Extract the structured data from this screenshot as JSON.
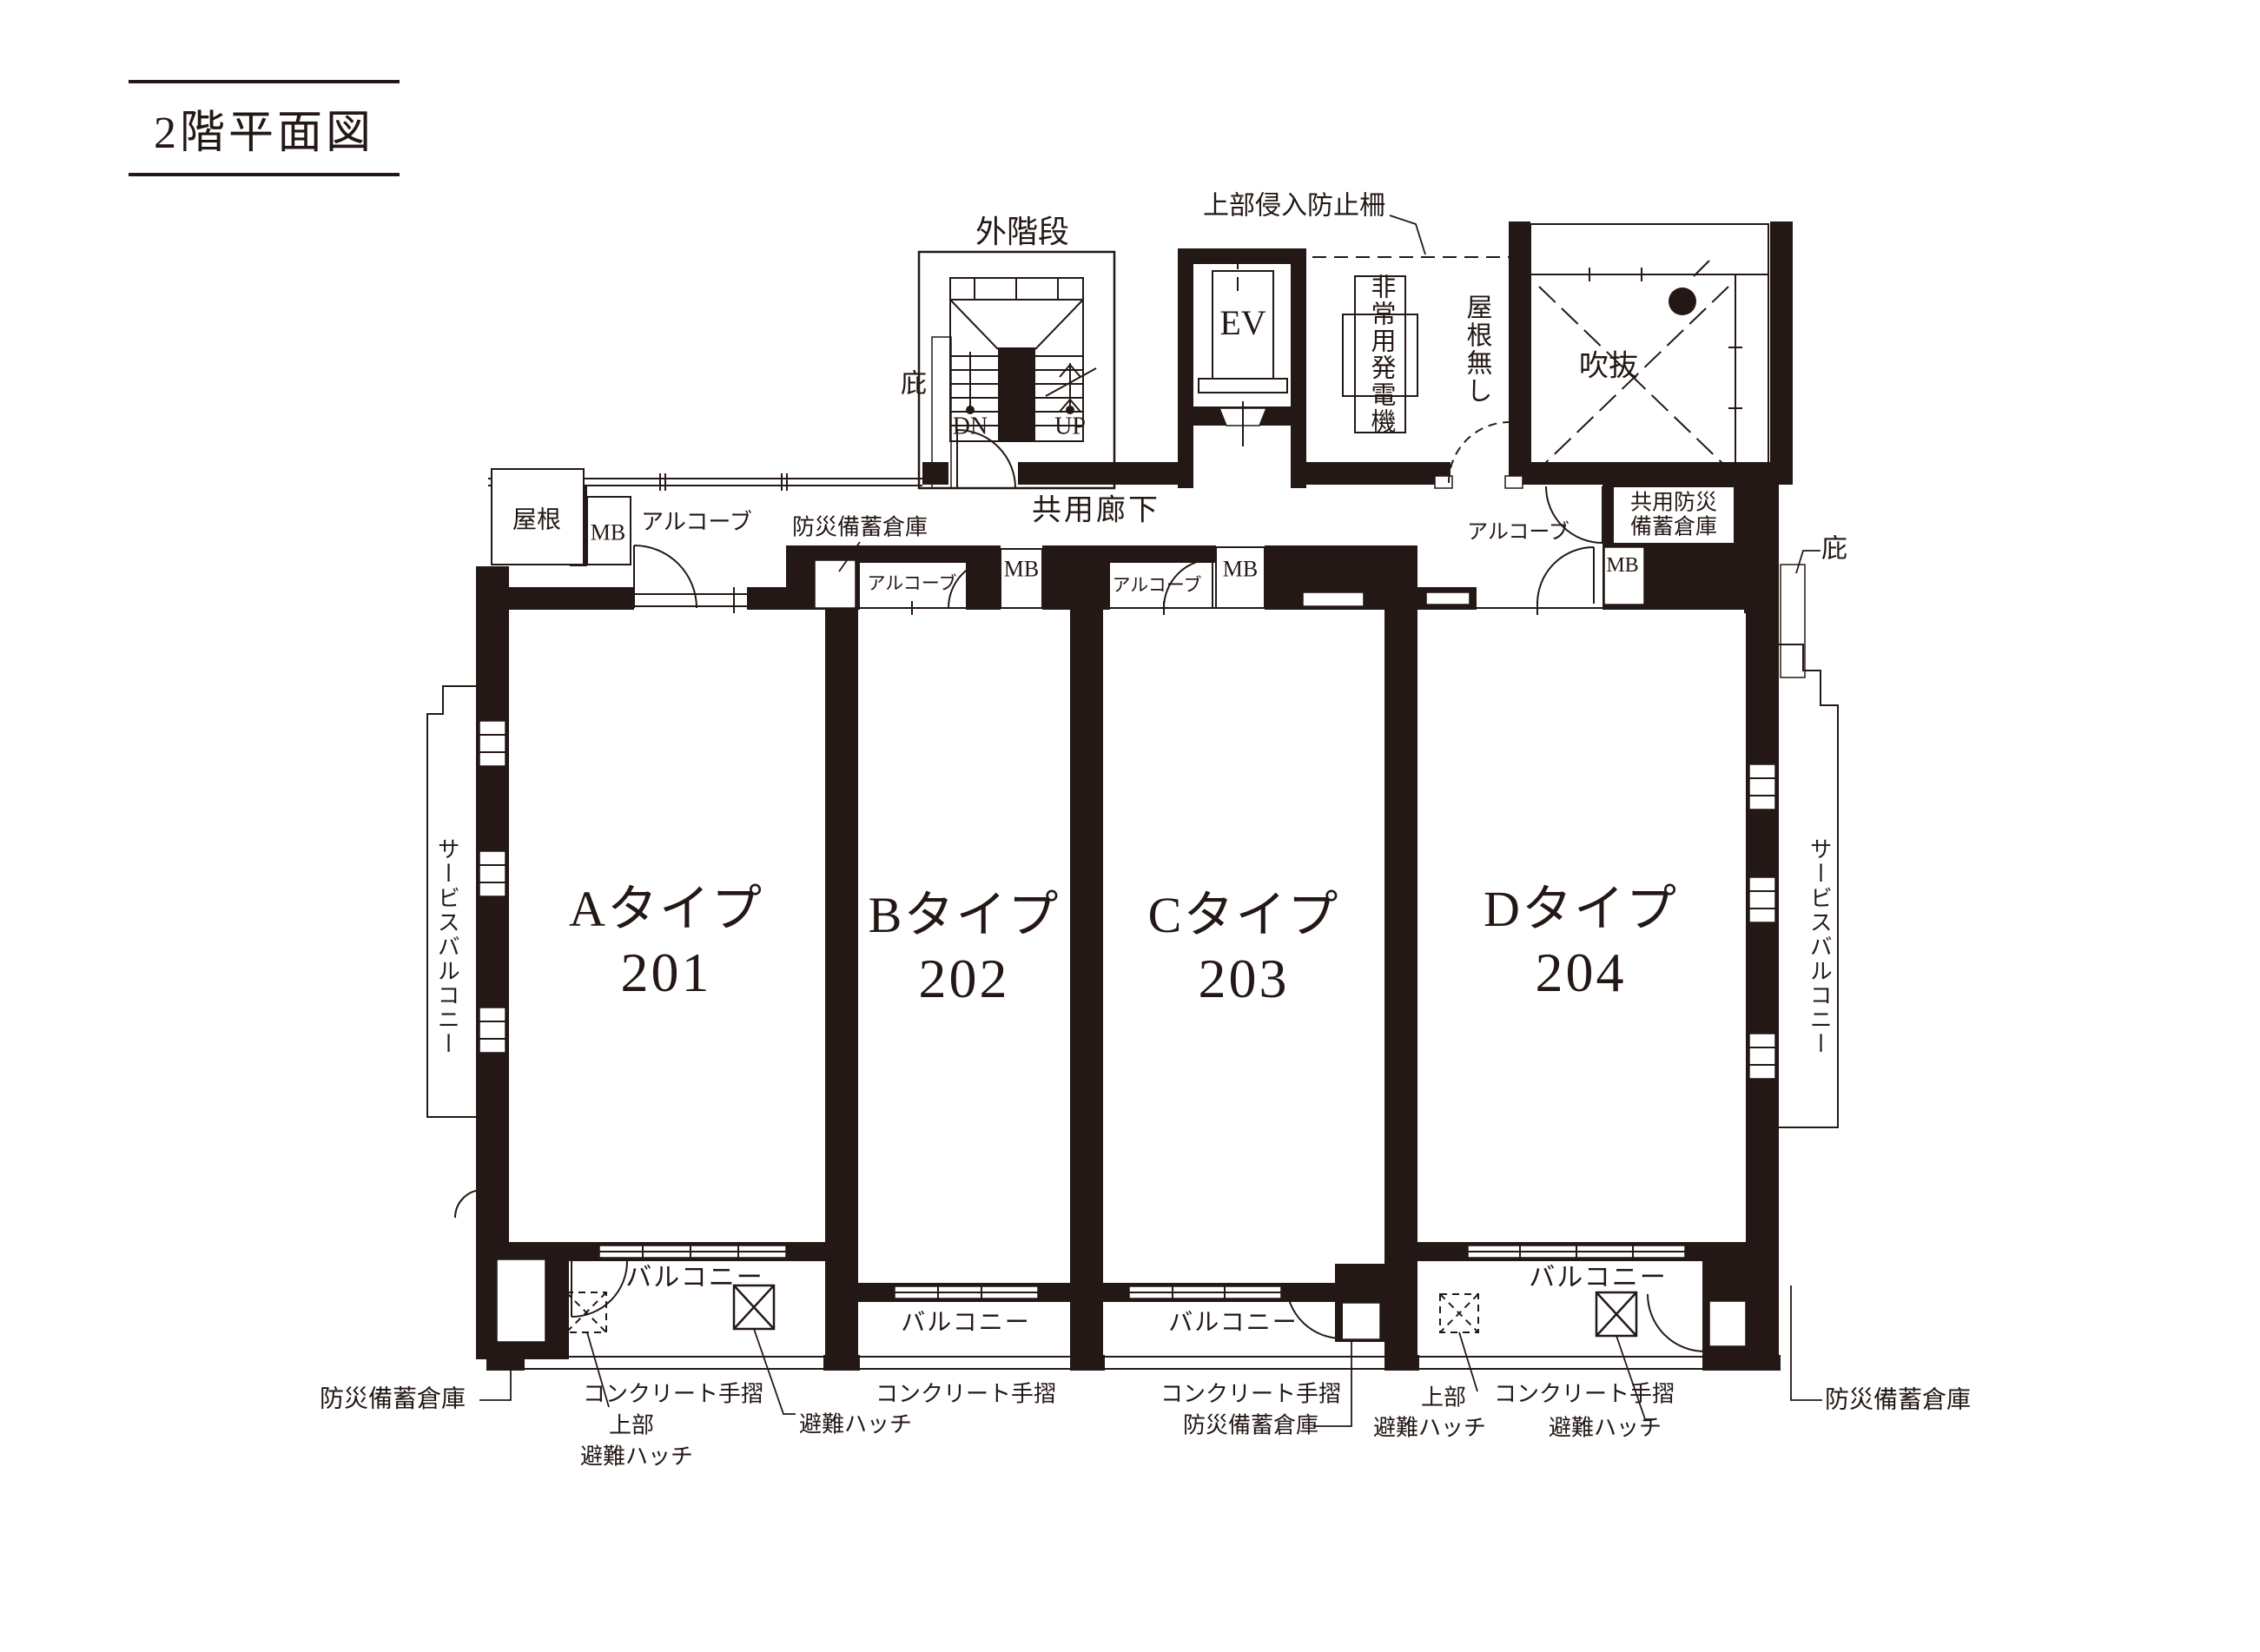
{
  "title": "2階平面図",
  "ink_color": "#231815",
  "top": {
    "outer_stairs": "外階段",
    "canopy": "庇",
    "dn": "DN",
    "up": "UP",
    "intrusion_fence": "上部侵入防止柵",
    "elevator": "EV",
    "generator": "非常用発電機",
    "no_roof": "屋根無し",
    "atrium": "吹抜"
  },
  "corridor": {
    "name": "共用廊下",
    "roof": "屋根",
    "mb": "MB",
    "alcove": "アルコーブ",
    "disaster_storage": "防災備蓄倉庫",
    "shared_disaster_storage_line1": "共用防災",
    "shared_disaster_storage_line2": "備蓄倉庫"
  },
  "units": [
    {
      "type": "Aタイプ",
      "number": "201"
    },
    {
      "type": "Bタイプ",
      "number": "202"
    },
    {
      "type": "Cタイプ",
      "number": "203"
    },
    {
      "type": "Dタイプ",
      "number": "204"
    }
  ],
  "service_balcony": "サービスバルコニー",
  "bottom": {
    "balcony": "バルコニー",
    "disaster_storage": "防災備蓄倉庫",
    "concrete_handrail": "コンクリート手摺",
    "upper": "上部",
    "escape_hatch": "避難ハッチ"
  }
}
